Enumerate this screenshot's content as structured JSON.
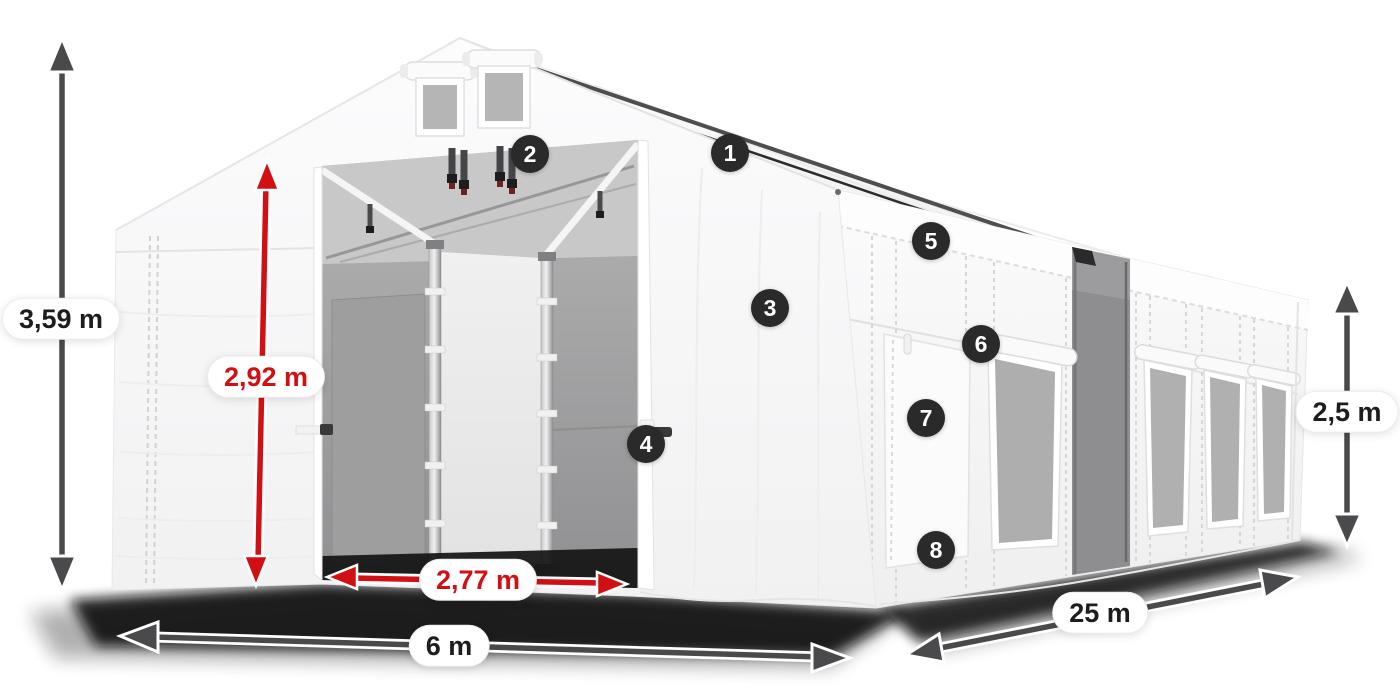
{
  "illustration": {
    "kind": "product-dimension-diagram",
    "subject": "white storage tent with open entrance, mesh windows and dimension arrows",
    "background": "#ffffff",
    "colors": {
      "dimension_arrow_gray": "#4a4a4c",
      "dimension_arrow_red": "#d21014",
      "label_pill_background": "#ffffff",
      "label_text_dark": "#1d1d1b",
      "label_text_red": "#d21014",
      "callout_background": "#2b2a2b",
      "callout_text": "#ffffff",
      "tent_fabric": "#f8f8f8",
      "tent_mesh": "#a7a7a8",
      "ground_shadow": "#111111"
    },
    "dimensions": [
      {
        "id": "total-height",
        "label": "3,59 m",
        "style": "gray",
        "orientation": "vertical"
      },
      {
        "id": "entrance-height",
        "label": "2,92 m",
        "style": "red",
        "orientation": "vertical"
      },
      {
        "id": "entrance-width",
        "label": "2,77 m",
        "style": "red",
        "orientation": "horizontal"
      },
      {
        "id": "gable-width",
        "label": "6 m",
        "style": "gray",
        "orientation": "horizontal"
      },
      {
        "id": "length",
        "label": "25 m",
        "style": "gray",
        "orientation": "diagonal"
      },
      {
        "id": "side-height",
        "label": "2,5 m",
        "style": "gray",
        "orientation": "vertical"
      }
    ],
    "callouts": [
      {
        "number": "1"
      },
      {
        "number": "2"
      },
      {
        "number": "3"
      },
      {
        "number": "4"
      },
      {
        "number": "5"
      },
      {
        "number": "6"
      },
      {
        "number": "7"
      },
      {
        "number": "8"
      }
    ]
  }
}
